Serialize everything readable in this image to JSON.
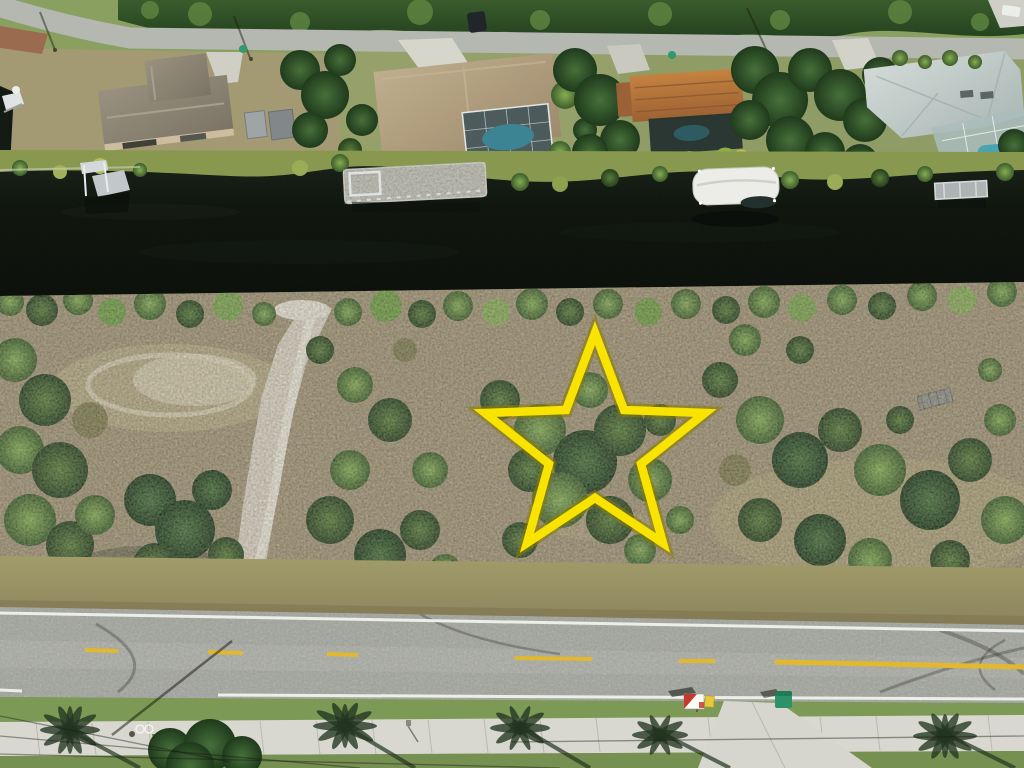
{
  "photo": {
    "kind": "aerial-drone-photo",
    "subject": "vacant waterfront lot marked with yellow star outline between a canal and a street"
  },
  "marker": {
    "shape": "five-point-star-outline",
    "points": "595,333 624,410 705,413 641,464 663,543 595,498 527,543 549,464 485,413 566,410",
    "stroke_color": "#f8e400",
    "halo_color": "#8a7c00"
  },
  "colors": {
    "water": "#12180f",
    "road_top": "#b5b7b1",
    "road_bottom": "#a8aaa4",
    "side_road": "#a5a7a1",
    "sidewalk": "#d8d8d0",
    "driveway": "#d6d6ce",
    "line_yellow": "#e2b82e",
    "line_white": "#eceee8",
    "curb_brick": "#ad6a4a",
    "grass_green": "#7c9a55",
    "scrub_tan": "#9f9173",
    "sand_white": "#d9d3c2",
    "shoulder_olive": "#99945f",
    "tree_dark": "#2c4726",
    "bush_green": "#6f9440",
    "bank_olive": "#88994f",
    "roof_gray": "#8f8878",
    "roof_tan": "#b3a084",
    "roof_orange": "#b5743f",
    "roof_light": "#c3cbc8",
    "pool_blue": "#3c8494",
    "pool_blue_right": "#4aa3b2",
    "boat_canopy": "#ecede8",
    "dock_gray": "#98988f",
    "lift_white": "#d4d8da",
    "sign_red": "#c33b2f",
    "sign_white": "#fdfdf8",
    "sign_rider_yellow": "#e8c93e",
    "bin_green": "#2d9268",
    "shadow_dark": "#27361f"
  }
}
